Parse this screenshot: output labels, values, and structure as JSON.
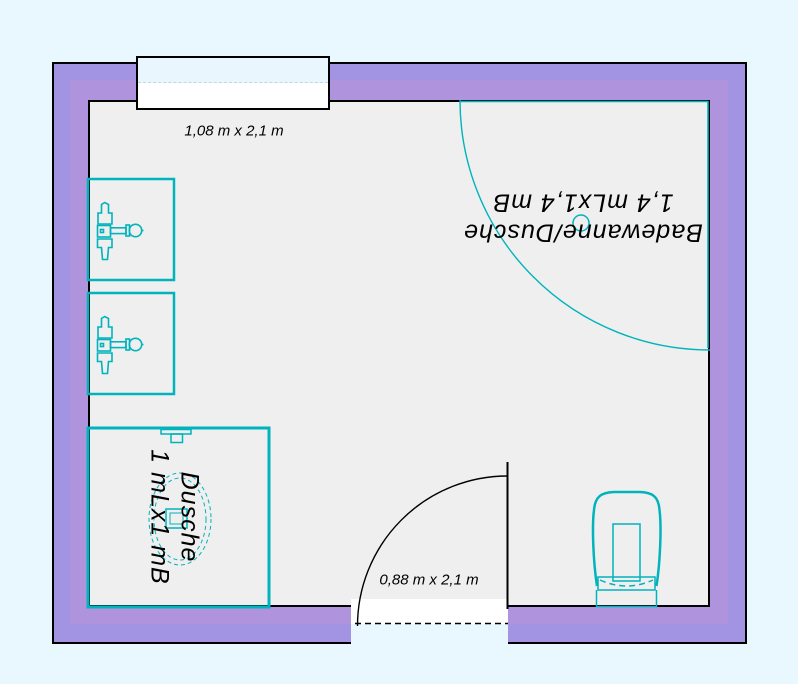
{
  "plan": {
    "window": {
      "label": "1,08 m x 2,1 m"
    },
    "door": {
      "label": "0,88 m x 2,1 m"
    },
    "bath": {
      "line1": "Badewanne/Dusche",
      "line2": "1,4 mLx1,4 mB"
    },
    "shower": {
      "line1": "Dusche",
      "line2": "1 mLx1 mB"
    },
    "colors": {
      "background": "#e9f8fe",
      "wall_outer": "#a293e3",
      "wall_inner": "#af94dd",
      "floor": "#efefef",
      "fixture": "#00b3bc",
      "outline": "#000000",
      "window_glass": "#e9f6fd"
    }
  }
}
